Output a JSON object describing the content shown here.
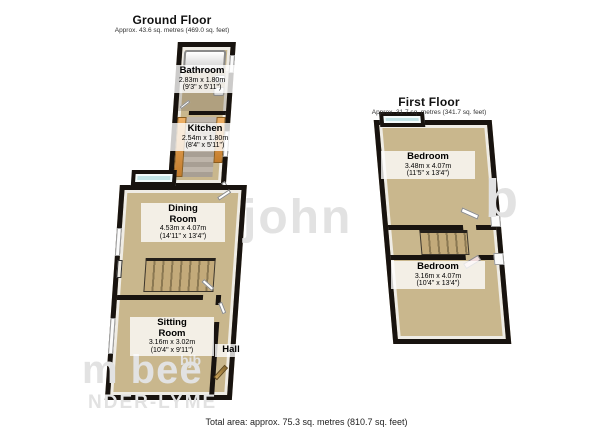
{
  "page": {
    "footer_total": "Total area: approx. 75.3 sq. metres (810.7 sq. feet)"
  },
  "watermark": {
    "center_fragment": "john",
    "right_fragment": "b",
    "bottom_fragment_large": "m bee",
    "bottom_fragment_small": "bjb",
    "bottom_fragment_caption": "NDER-LYME"
  },
  "floors": [
    {
      "title": "Ground Floor",
      "subtitle": "Approx. 43.6 sq. metres (469.0 sq. feet)",
      "rooms": [
        {
          "name": "Bathroom",
          "metric": "2.83m x 1.80m",
          "imperial": "(9'3\" x 5'11\")"
        },
        {
          "name": "Kitchen",
          "metric": "2.54m x 1.80m",
          "imperial": "(8'4\" x 5'11\")"
        },
        {
          "name": "Dining Room",
          "metric": "4.53m x 4.07m",
          "imperial": "(14'11\" x 13'4\")"
        },
        {
          "name": "Sitting Room",
          "metric": "3.16m x 3.02m",
          "imperial": "(10'4\" x 9'11\")"
        },
        {
          "name": "Hall"
        }
      ]
    },
    {
      "title": "First Floor",
      "subtitle": "Approx. 31.7 sq. metres (341.7 sq. feet)",
      "rooms": [
        {
          "name": "Bedroom",
          "metric": "3.48m x 4.07m",
          "imperial": "(11'5\" x 13'4\")"
        },
        {
          "name": "Bedroom",
          "metric": "3.16m x 4.07m",
          "imperial": "(10'4\" x 13'4\")"
        }
      ]
    }
  ],
  "colors": {
    "wall": "#18130f",
    "floor": "#c9b78d",
    "bay-glass": "#c3e4e6",
    "cabinet": "#e09a45",
    "stair": "#c3aa7a",
    "stair-line": "#8b7852",
    "inner-wall": "#efece5",
    "label-bg": "rgba(255,255,255,0.78)",
    "watermark": "#e2e2e2",
    "text": "#111111"
  }
}
